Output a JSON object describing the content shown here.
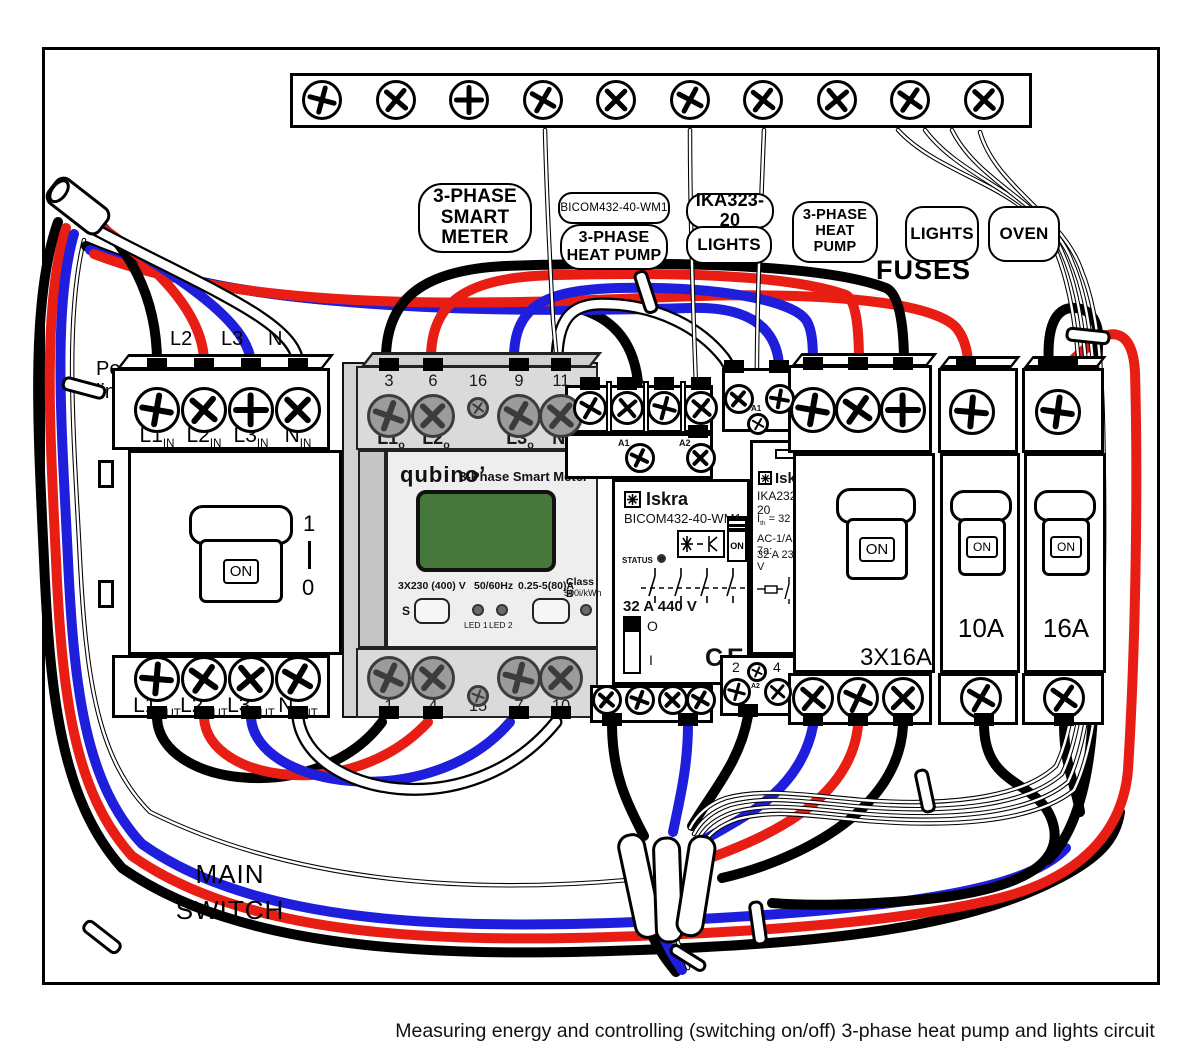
{
  "caption": "Measuring energy and controlling (switching on/off) 3-phase heat pump and lights circuit",
  "colors": {
    "wire_black": "#000000",
    "wire_red": "#e81e14",
    "wire_blue": "#1e1edc",
    "wire_white": "#ffffff",
    "lcd_green": "#46783c",
    "gray_top": "#dadada",
    "gray_face": "#eeeeee",
    "gray_side": "#c6c6c6",
    "gray_back": "#d2d2d2"
  },
  "power_in": {
    "line1": "Power",
    "line2": "line - L1",
    "l2": "L2",
    "l3": "L3",
    "n": "N"
  },
  "tags": {
    "smart_meter": {
      "l1": "3-PHASE",
      "l2": "SMART",
      "l3": "METER"
    },
    "bicom": "BICOM432-40-WM1",
    "heat_pump1": {
      "l1": "3-PHASE",
      "l2": "HEAT PUMP"
    },
    "ika": "IKA323-20",
    "lights1": "LIGHTS",
    "heat_pump2": {
      "l1": "3-PHASE",
      "l2": "HEAT PUMP"
    },
    "lights2": "LIGHTS",
    "oven": "OVEN",
    "fuses": "FUSES"
  },
  "main_switch": {
    "in": [
      {
        "b": "L1",
        "s": "IN"
      },
      {
        "b": "L2",
        "s": "IN"
      },
      {
        "b": "L3",
        "s": "IN"
      },
      {
        "b": "N",
        "s": "IN"
      }
    ],
    "out": [
      {
        "b": "L1",
        "s": "OUT"
      },
      {
        "b": "L2",
        "s": "OUT"
      },
      {
        "b": "L3",
        "s": "OUT"
      },
      {
        "b": "N",
        "s": "OUT"
      }
    ],
    "on": "ON",
    "pos_on": "1",
    "pos_off": "0",
    "label1": "MAIN",
    "label2": "SWITCH"
  },
  "meter": {
    "brand": "qubino’",
    "title": "3-Phase Smart Meter",
    "top_numbers": [
      "3",
      "6",
      "16",
      "9",
      "11"
    ],
    "top_labels": [
      {
        "b": "L1",
        "s": "o"
      },
      {
        "b": "L2",
        "s": "o"
      },
      {
        "b": "L3",
        "s": "o"
      },
      {
        "b": "N",
        "s": "o"
      }
    ],
    "specs": [
      "3X230 (400) V",
      "50/60Hz",
      "0.25-5(80)A"
    ],
    "class_line1": "Class B",
    "class_line2": "500i/kWh",
    "s_button": "S",
    "led1": "LED 1",
    "led2": "LED 2",
    "bottom_numbers": [
      "1",
      "4",
      "15",
      "7",
      "10"
    ]
  },
  "bicom": {
    "brand": "Iskra",
    "model": "BICOM432-40-WM1",
    "status": "STATUS",
    "rating": "32 A 440 V",
    "on": "ON",
    "off": "O",
    "i": "I",
    "ce": "CE",
    "a1": "A1",
    "a2": "A2"
  },
  "ika": {
    "brand": "Iskra",
    "model": "IKA232-20",
    "ith_pre": "I",
    "ith_sub": "th",
    "ith_post": " = 32 A",
    "line2": "AC-1/AC-7a:",
    "line3": "32 A 230 V",
    "t1": "1",
    "ta1": "A1",
    "t3": "3",
    "b2": "2",
    "ba2": "A2",
    "b4": "4"
  },
  "breakers": {
    "b3": {
      "on": "ON",
      "label": "3X16A"
    },
    "b10": {
      "on": "ON",
      "label": "10A"
    },
    "b16": {
      "on": "ON",
      "label": "16A"
    }
  }
}
